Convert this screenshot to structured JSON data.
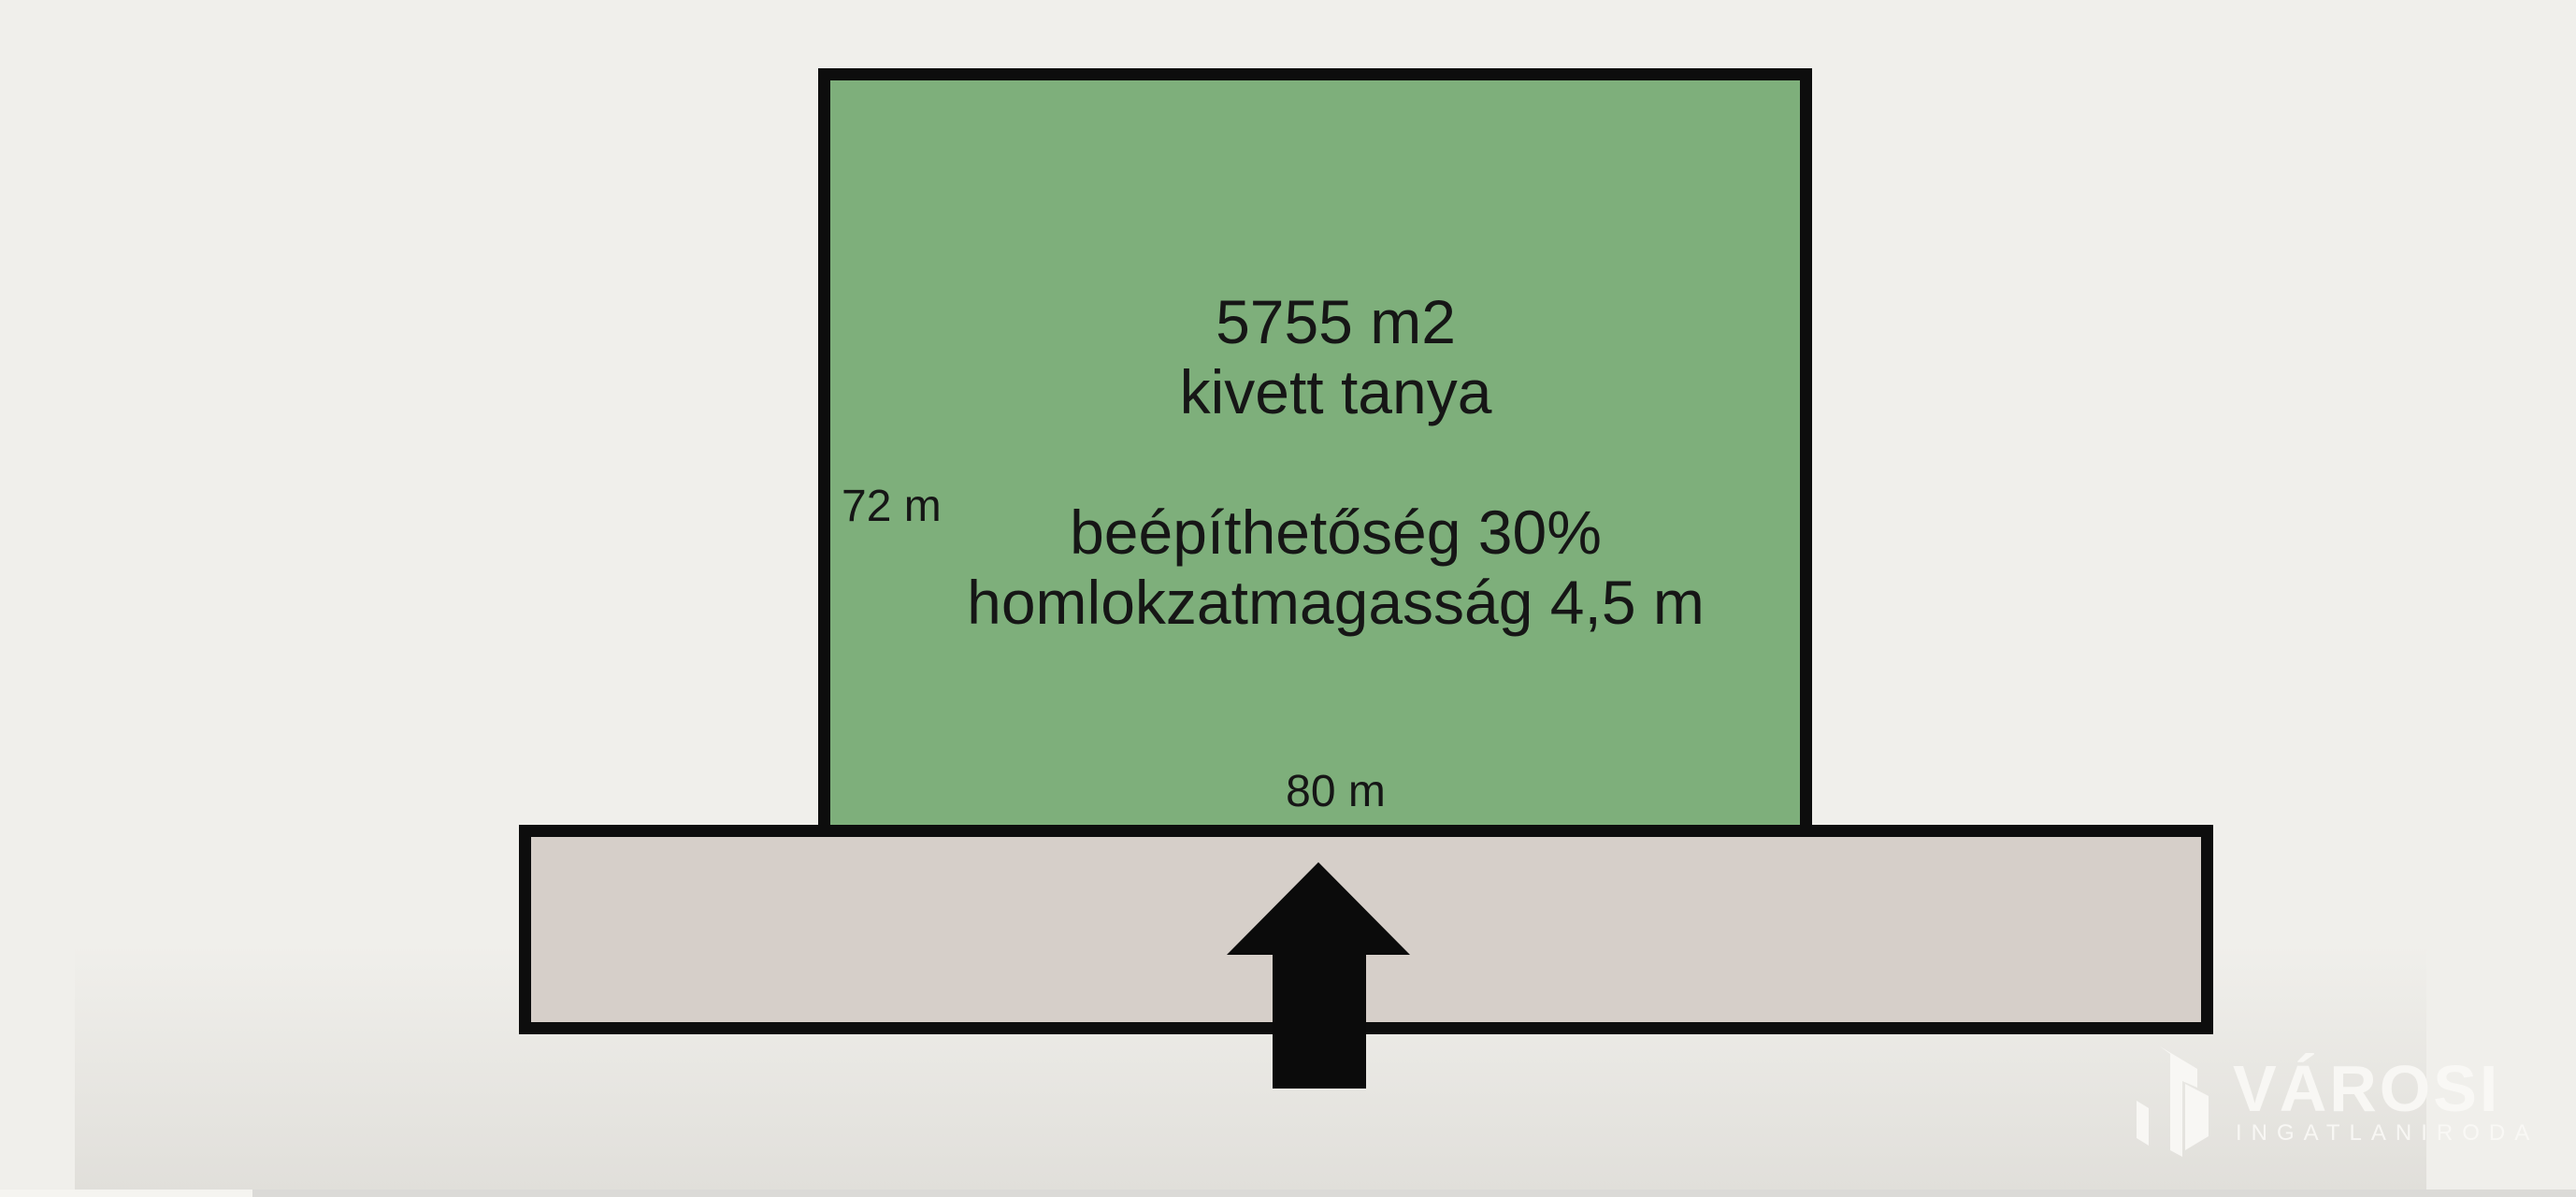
{
  "page": {
    "background_color": "#F0EFEB"
  },
  "diagram": {
    "border_color": "#0D0D0D",
    "plot": {
      "fill_color": "#7EAF7B",
      "area_label": "5755 m2",
      "land_use_label": "kivett tanya",
      "coverage_label": "beépíthetőség 30%",
      "facade_height_label": "homlokzatmagasság 4,5 m",
      "side_length_label": "72 m",
      "front_length_label": "80 m"
    },
    "road": {
      "fill_color": "#D6CFC9"
    },
    "entrance_arrow": {
      "icon": "up-arrow-icon",
      "color": "#0B0B0B"
    }
  },
  "watermark": {
    "icon": "buildings-icon",
    "brand": "VÁROSI",
    "subtitle": "INGATLANIRODA",
    "color": "#FAF9F6"
  },
  "player": {
    "progress_track_color": "#DBDAD7",
    "progress_played_color": "#F5F4F0"
  }
}
